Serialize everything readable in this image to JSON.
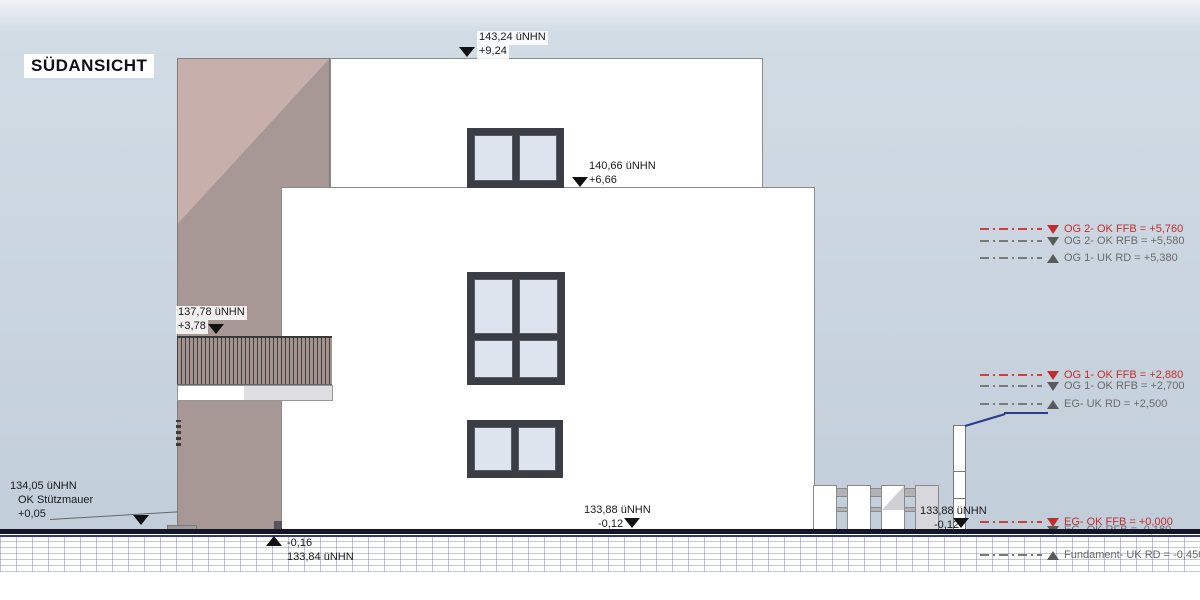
{
  "title": "SÜDANSICHT",
  "marks": {
    "ridge": {
      "l1": "143,24 üNHN",
      "l2": "+9,24"
    },
    "upper": {
      "l1": "140,66 üNHN",
      "l2": "+6,66"
    },
    "balcony": {
      "l1": "137,78 üNHN",
      "l2": "+3,78"
    },
    "wall": {
      "l1": "134,05 üNHN",
      "l2": "OK Stützmauer",
      "l3": "+0,05"
    },
    "ground_left": {
      "l1": "-0,16",
      "l2": "133,84 üNHN"
    },
    "ground_mid": {
      "l1": "133,88 üNHN",
      "l2": "-0,12"
    },
    "ground_right": {
      "l1": "133,88 üNHN",
      "l2": "-0,12"
    }
  },
  "levels": {
    "og2": [
      {
        "label": "OG 2- OK FFB  =  +5,760"
      },
      {
        "label": "OG 2- OK RFB  =  +5,580"
      },
      {
        "label": "OG 1- UK RD  =  +5,380"
      }
    ],
    "og1": [
      {
        "label": "OG 1- OK FFB  =  +2,880"
      },
      {
        "label": "OG 1- OK RFB  =  +2,700"
      },
      {
        "label": "EG- UK RD  =  +2,500"
      }
    ],
    "eg": [
      {
        "label": "EG- OK FFB  =  +0,000"
      },
      {
        "label": "EG- OK RFB  =  -0,180"
      },
      {
        "label": "Fundament- UK RD  =  -0,450"
      }
    ]
  },
  "colors": {
    "accent_red": "#c22e2e",
    "annotation_gray": "#6b6b6b",
    "facade_light": "#c7b0ab",
    "facade_dark": "#a89895",
    "window_frame": "#3a3e44",
    "glass": "#dde4ee",
    "ground_band": "#14152a",
    "ground_blue": "#2e3a85"
  }
}
